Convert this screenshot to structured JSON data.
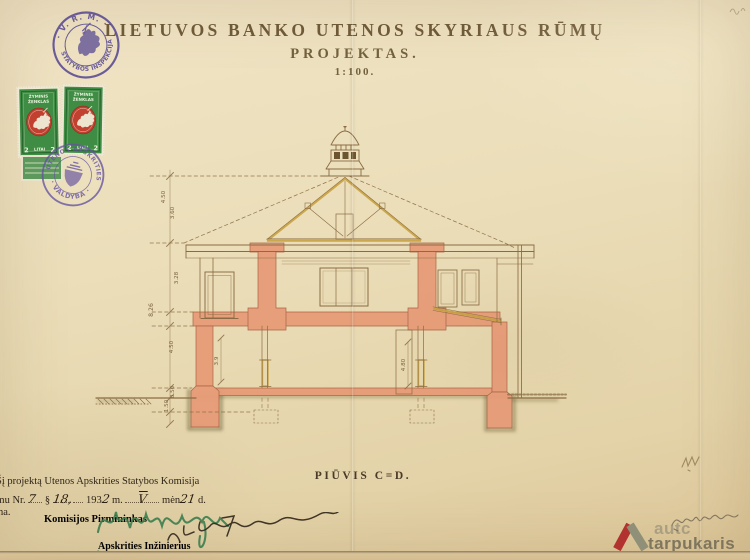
{
  "title": {
    "line1": "LIETUVOS BANKO UTENOS SKYRIAUS RŪMŲ",
    "line2": "PROJEKTAS.",
    "scale": "1:100."
  },
  "stamps": {
    "inspekcija": {
      "arc_top": "· V. R. M. ·",
      "arc_bottom": "STATYBOS INSPEKCIJA"
    },
    "valdyba": {
      "arc_top": "UTENOS APSKRITIES",
      "arc_bottom": "· VALDYBA ·"
    },
    "revenue": {
      "top1": "ŽYMINIS",
      "top2": "ŽENKLAS",
      "val_l": "2",
      "word": "LITAI",
      "val_r": "2"
    }
  },
  "drawing": {
    "caption": "PIŪVIS C=D.",
    "dims_left": [
      "4.50",
      "3.60",
      "3.28",
      "8.26",
      "4.50",
      "0.50",
      "1.50"
    ],
    "dims_inner": [
      "3.9",
      "4.80"
    ]
  },
  "approval": {
    "line1": "Šį projektą Utenos Apskrities Statybos Komisija",
    "line2_pre": "rimu Nr.",
    "no": "7",
    "sect": "§",
    "sect_no": "18,",
    "year_pre": "193",
    "year_hand": "2",
    "m_label": "m.",
    "month": "V",
    "men_label": "mėn",
    "day": "21",
    "d_label": "d.",
    "line3": "na.",
    "chairman": "Komisijos Pirmininkas",
    "engineer": "Apskrities Inžinierius"
  },
  "watermark": {
    "word1": "autc",
    "word2": "tarpukaris"
  }
}
